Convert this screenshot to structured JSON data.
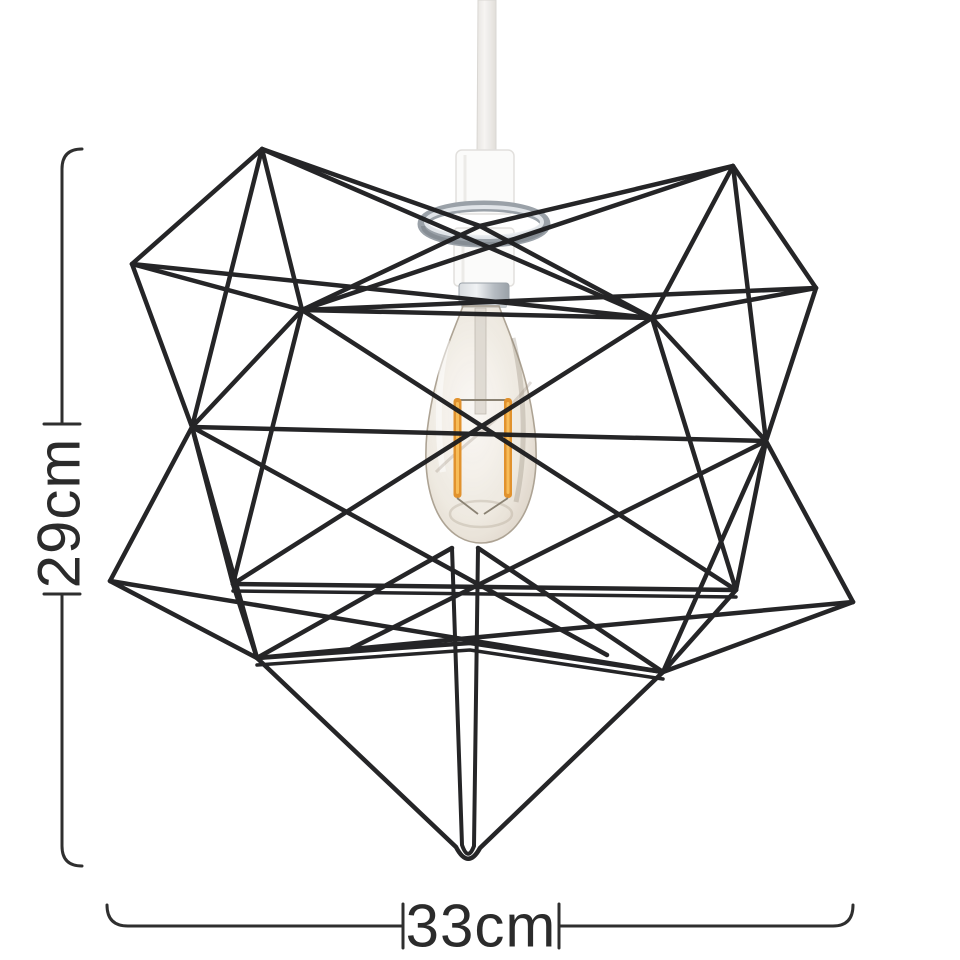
{
  "dimensions": {
    "height": "29cm",
    "width": "33cm"
  },
  "scene": {
    "shade": "black wire geometric star lampshade",
    "bulb": "amber Edison filament bulb",
    "holder": "white pendant lamp holder with chrome ring",
    "cord": "white ceiling cord"
  },
  "colors": {
    "background": "#ffffff",
    "wire": "#1d1d1f",
    "dimension_line": "#2f2f2f",
    "label_text": "#2b2b2b",
    "chrome": "#a9b0b7",
    "holder_white": "#fbfbfa",
    "cord_white": "#f1efec",
    "bulb_glass": "#d9cebc",
    "filament_amber": "#e79f37"
  }
}
